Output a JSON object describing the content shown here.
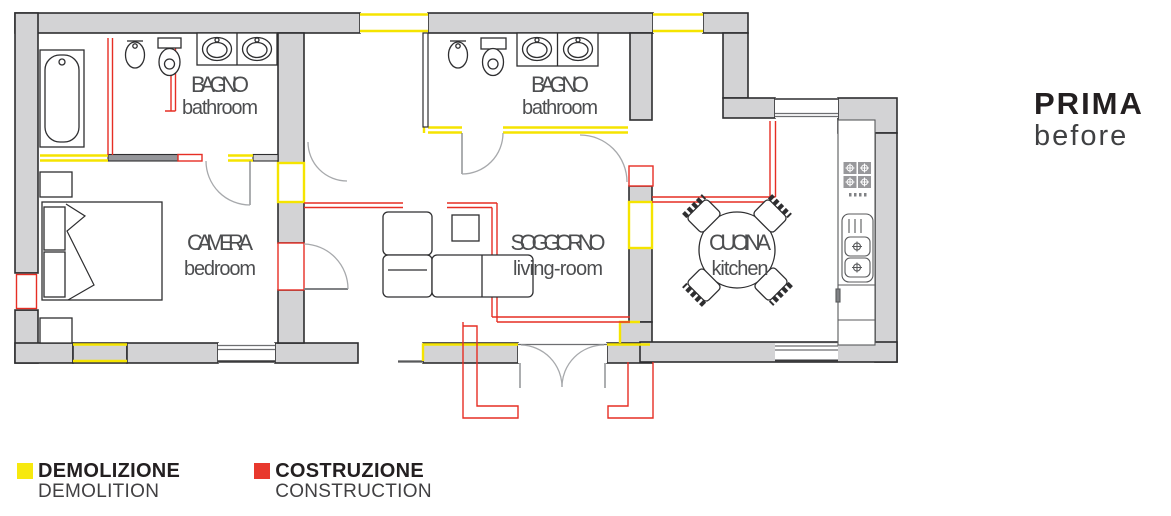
{
  "title": {
    "main": "PRIMA",
    "sub": "before"
  },
  "rooms": {
    "bagno1": {
      "name": "BAGNO",
      "sub": "bathroom"
    },
    "bagno2": {
      "name": "BAGNO",
      "sub": "bathroom"
    },
    "camera": {
      "name": "CAMERA",
      "sub": "bedroom"
    },
    "soggiorno": {
      "name": "SOGGIORNO",
      "sub": "living-room"
    },
    "cucina": {
      "name": "CUCINA",
      "sub": "kitchen"
    }
  },
  "legend": {
    "demolition": {
      "label": "DEMOLIZIONE",
      "sub": "DEMOLITION",
      "color": "#f7e90e"
    },
    "construction": {
      "label": "COSTRUZIONE",
      "sub": "CONSTRUCTION",
      "color": "#e8382d"
    }
  },
  "colors": {
    "wall_fill": "#d3d3d5",
    "wall_stroke": "#2e2e30",
    "demolition_line": "#f5e400",
    "construction_line": "#e62e24",
    "door_arc": "#a7a9ac",
    "label_text": "#4d4e50"
  }
}
